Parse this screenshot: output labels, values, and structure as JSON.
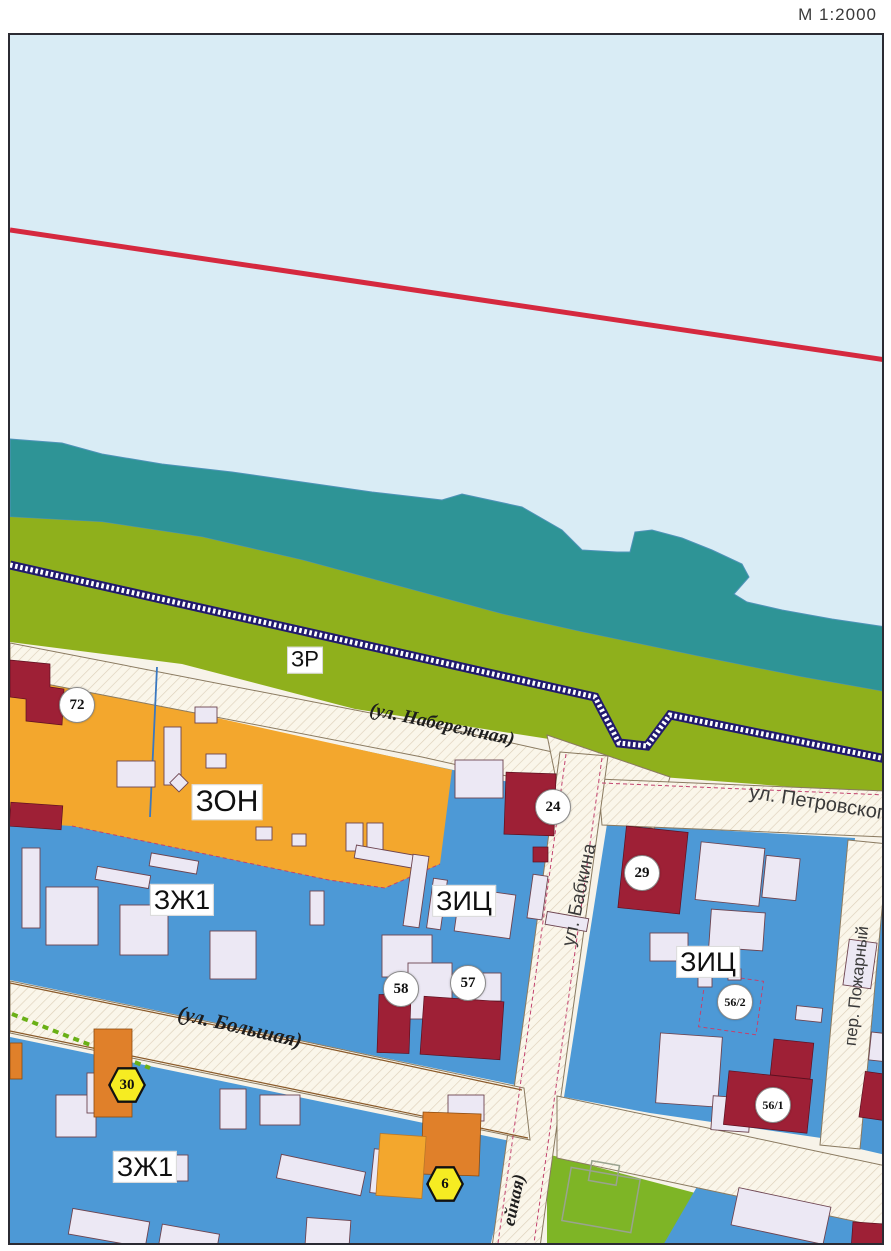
{
  "page": {
    "scale_label": "М 1:2000"
  },
  "map_colors": {
    "water": "#d9ecf5",
    "river_shallow_teal": "#2e9496",
    "embankment_green": "#8fb01c",
    "park_green": "#7eb526",
    "residential_blue": "#4d99d6",
    "public_orange_zone": "#f3a72d",
    "orange_building": "#e0802a",
    "heritage_red_building": "#9e2036",
    "red_boundary_line": "#d5293f",
    "embankment_stripe_navy": "#211a6d",
    "street_paper": "#f7f3e9"
  },
  "zone_labels": [
    {
      "id": "zr",
      "text": "ЗР",
      "x": 295,
      "y": 625,
      "size": 22
    },
    {
      "id": "zon",
      "text": "ЗОН",
      "x": 217,
      "y": 767,
      "size": 30
    },
    {
      "id": "zh1-north",
      "text": "ЗЖ1",
      "x": 172,
      "y": 865,
      "size": 27
    },
    {
      "id": "zic-west",
      "text": "ЗИЦ",
      "x": 454,
      "y": 866,
      "size": 27
    },
    {
      "id": "zic-east",
      "text": "ЗИЦ",
      "x": 698,
      "y": 927,
      "size": 27
    },
    {
      "id": "zh1-south",
      "text": "ЗЖ1",
      "x": 135,
      "y": 1132,
      "size": 27
    }
  ],
  "street_labels": [
    {
      "id": "naberezhnaya",
      "text": "(ул. Набережная)",
      "x": 432,
      "y": 690,
      "rot": 12,
      "style": "serif",
      "size": 19
    },
    {
      "id": "petrovskogo",
      "text": "ул. Петровского",
      "x": 812,
      "y": 769,
      "rot": 9,
      "style": "sans",
      "size": 20
    },
    {
      "id": "babkina",
      "text": "ул. Бабкина",
      "x": 570,
      "y": 860,
      "rot": -78,
      "style": "sans",
      "size": 19
    },
    {
      "id": "bolshaya",
      "text": "(ул. Большая)",
      "x": 230,
      "y": 992,
      "rot": 13,
      "style": "serif",
      "size": 21
    },
    {
      "id": "pozharny",
      "text": "пер. Пожарный",
      "x": 847,
      "y": 951,
      "rot": -84,
      "style": "sans",
      "size": 17
    },
    {
      "id": "unnamed-south",
      "text": "ейная)",
      "x": 504,
      "y": 1165,
      "rot": -78,
      "style": "serif",
      "size": 18
    }
  ],
  "circle_markers": [
    {
      "id": "72",
      "text": "72",
      "x": 67,
      "y": 670
    },
    {
      "id": "24",
      "text": "24",
      "x": 543,
      "y": 772
    },
    {
      "id": "29",
      "text": "29",
      "x": 632,
      "y": 838
    },
    {
      "id": "58",
      "text": "58",
      "x": 391,
      "y": 954
    },
    {
      "id": "57",
      "text": "57",
      "x": 458,
      "y": 948
    },
    {
      "id": "56/2",
      "text": "56/2",
      "x": 725,
      "y": 967
    },
    {
      "id": "56/1",
      "text": "56/1",
      "x": 763,
      "y": 1070
    }
  ],
  "hex_markers": [
    {
      "id": "30",
      "text": "30",
      "x": 117,
      "y": 1050
    },
    {
      "id": "6",
      "text": "6",
      "x": 435,
      "y": 1149
    }
  ]
}
